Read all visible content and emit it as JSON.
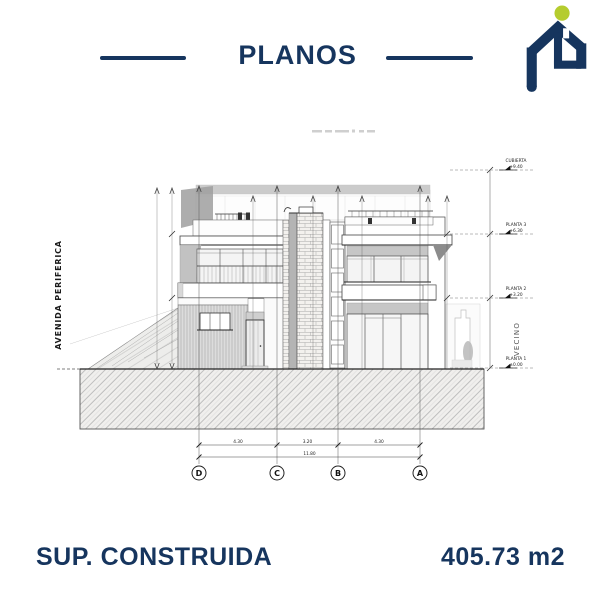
{
  "header": {
    "title": "PLANOS",
    "divider_color": "#16355e",
    "logo": {
      "icon": "house-p-logo",
      "dot_icon": "green-dot",
      "navy": "#16355e",
      "green": "#b5cc2e"
    }
  },
  "drawing": {
    "street_label": "AVENIDA PERIFERICA",
    "neighbor_label": "VECINO",
    "levels": [
      {
        "name": "CUBIERTA",
        "elevation": "+9.40"
      },
      {
        "name": "PLANTA 3",
        "elevation": "+6.30"
      },
      {
        "name": "PLANTA 2",
        "elevation": "+3.20"
      },
      {
        "name": "PLANTA 1",
        "elevation": "±0.00"
      }
    ],
    "grid_axes": [
      "D",
      "C",
      "B",
      "A"
    ],
    "dimensions": {
      "d_c": "4.30",
      "c_b": "3.20",
      "b_a": "4.30",
      "total": "11.80"
    }
  },
  "footer": {
    "label": "SUP. CONSTRUIDA",
    "value": "405.73 m2"
  }
}
